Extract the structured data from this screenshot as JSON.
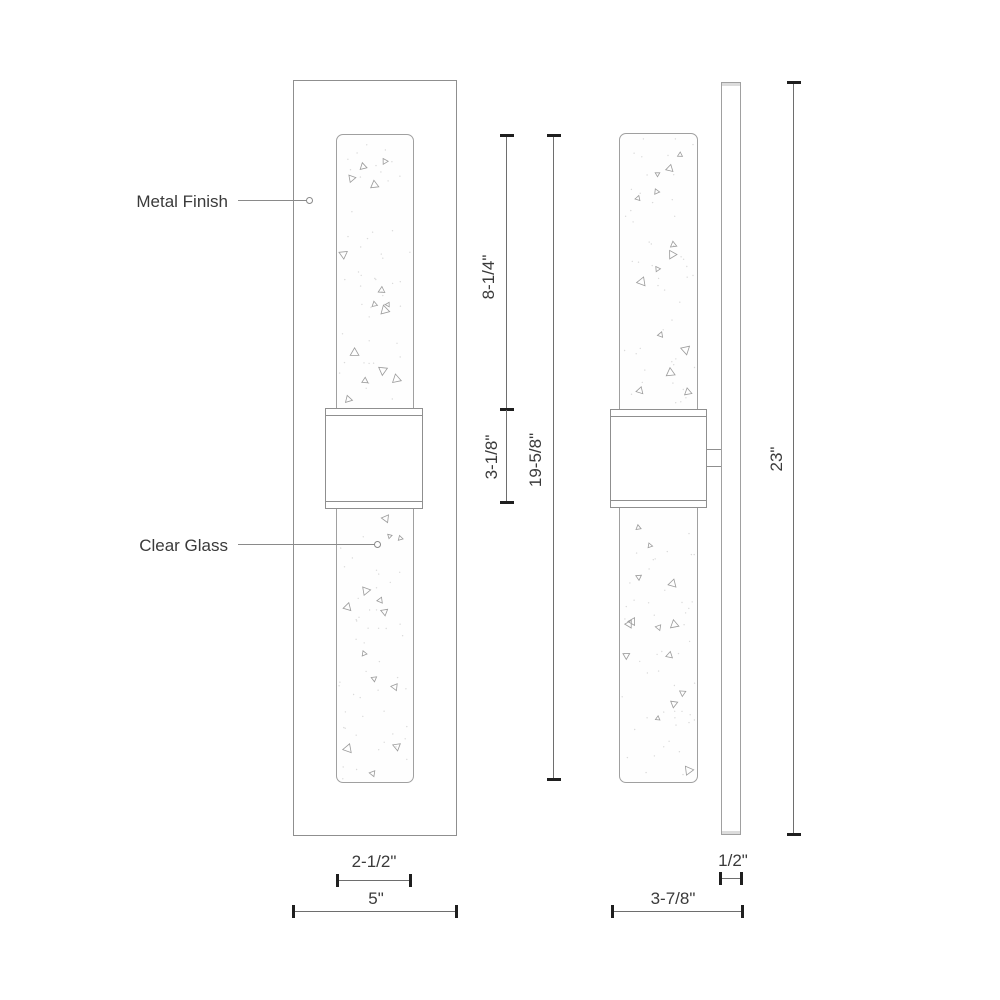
{
  "annotations": {
    "metal_finish": "Metal Finish",
    "clear_glass": "Clear Glass"
  },
  "dimensions": {
    "upper_glass_height": "8-1/4\"",
    "band_height": "3-1/8\"",
    "glass_total_height": "19-5/8\"",
    "overall_height": "23\"",
    "glass_width": "2-1/2\"",
    "backplate_width": "5\"",
    "plate_depth": "1/2\"",
    "overall_depth": "3-7/8\""
  },
  "colors": {
    "outline": "#8f8f8f",
    "glass_outline": "#a0a0a0",
    "dimension_line": "#6e6e6e",
    "tick": "#1f1f1f",
    "text": "#3a3a3a",
    "leader": "#8a8a8a"
  }
}
